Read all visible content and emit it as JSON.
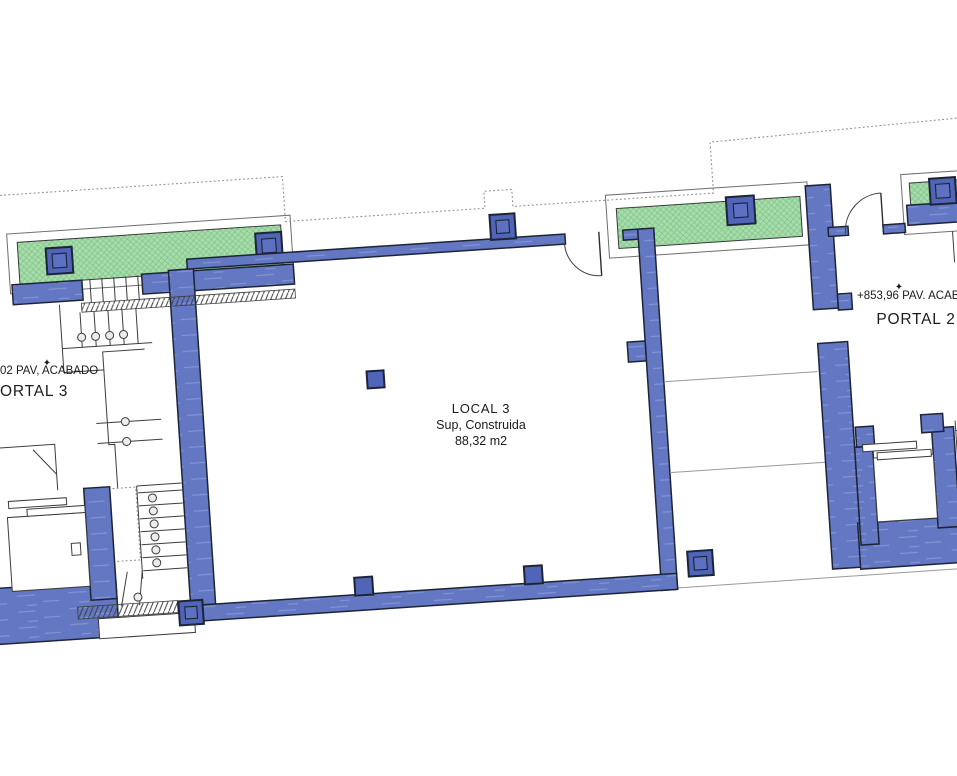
{
  "drawing": {
    "local3": {
      "title": "LOCAL 3",
      "subtitle": "Sup, Construida",
      "area": "88,32 m2"
    },
    "portal2": {
      "label": "PORTAL 2",
      "elevation": "+853,96 PAV. ACABADO",
      "benchmark": "✦"
    },
    "portal3": {
      "label": "ORTAL 3",
      "elevation": "02 PAV, ACABADO",
      "benchmark": "✦"
    }
  },
  "colors": {
    "wall": "#6377c3",
    "wall-streak": "#8d9cd9",
    "outline": "#1d2436",
    "column": "#5064b8",
    "column-inner": "#5d70c2",
    "green": "#a8dcab",
    "green-hatch": "#7fc489",
    "dash": "#8f8f8f",
    "text": "#1c1c1c"
  }
}
